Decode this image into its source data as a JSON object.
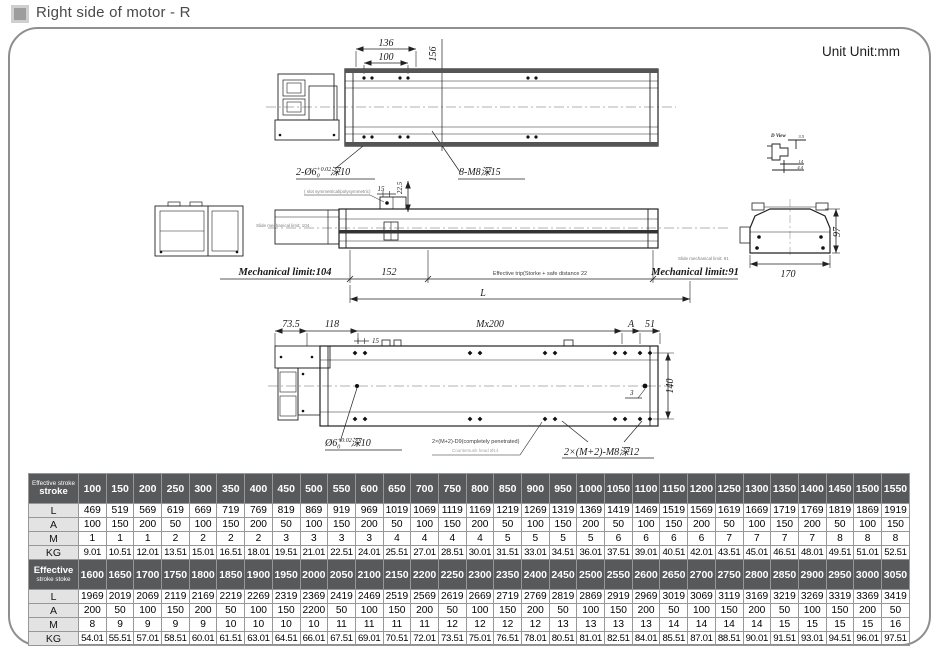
{
  "page": {
    "title": "Right side of motor - R",
    "unit_label": "Unit Unit:mm"
  },
  "drawings": {
    "top_view": {
      "dim_width_outer": "136",
      "dim_width_inner": "100",
      "dim_height": "156",
      "hole_pre": "2-Ø6",
      "hole_sup": "+0.02",
      "hole_sub": "0",
      "hole_post": "深10",
      "tap_label": "8-M8深15"
    },
    "side_view": {
      "note": "( slot symmetrical/polysymmetric)",
      "dim_block": "15",
      "dim_height": "22.5",
      "slide_limit_left": "Slide mechanical limit: 104",
      "mech_limit_left": "Mechanical limit:104",
      "dim_152": "152",
      "effective_trip": "Effective trip(Storke + safe distance 22",
      "dim_total": "L",
      "slide_limit_right": "Slide mechanical limit: 91",
      "mech_limit_right": "Mechanical limit:91"
    },
    "d_view": {
      "title": "D View",
      "dim1": "3.5",
      "dim2": "14",
      "dim3": "4.4"
    },
    "cross_section": {
      "dim_width": "170",
      "dim_height": "97"
    },
    "bottom_view": {
      "dim_735": "73.5",
      "dim_118": "118",
      "dim_15": "15",
      "dim_pitch": "Mx200",
      "dim_a": "A",
      "dim_51": "51",
      "dim_3": "3",
      "dim_140": "140",
      "hole_pre": "Ø6",
      "hole_sup": "+0.02",
      "hole_sub": "0",
      "hole_post": "深10",
      "through_label": "2×(M+2)-D9(completely penetrated)",
      "counter_label": "Countersunk head Ø14",
      "tap_label": "2×(M+2)-M8深12"
    }
  },
  "tables": [
    {
      "header": {
        "line1": "Effective stroke",
        "line2": "stroke",
        "big": "line2"
      },
      "strokes": [
        100,
        150,
        200,
        250,
        300,
        350,
        400,
        450,
        500,
        550,
        600,
        650,
        700,
        750,
        800,
        850,
        900,
        950,
        1000,
        1050,
        1100,
        1150,
        1200,
        1250,
        1300,
        1350,
        1400,
        1450,
        1500,
        1550
      ],
      "rows": [
        {
          "label": "L",
          "values": [
            469,
            519,
            569,
            619,
            669,
            719,
            769,
            819,
            869,
            919,
            969,
            1019,
            1069,
            1119,
            1169,
            1219,
            1269,
            1319,
            1369,
            1419,
            1469,
            1519,
            1569,
            1619,
            1669,
            1719,
            1769,
            1819,
            1869,
            1919
          ]
        },
        {
          "label": "A",
          "values": [
            100,
            150,
            200,
            50,
            100,
            150,
            200,
            50,
            100,
            150,
            200,
            50,
            100,
            150,
            200,
            50,
            100,
            150,
            200,
            50,
            100,
            150,
            200,
            50,
            100,
            150,
            200,
            50,
            100,
            150
          ]
        },
        {
          "label": "M",
          "values": [
            1,
            1,
            1,
            2,
            2,
            2,
            2,
            3,
            3,
            3,
            3,
            4,
            4,
            4,
            4,
            5,
            5,
            5,
            5,
            6,
            6,
            6,
            6,
            7,
            7,
            7,
            7,
            8,
            8,
            8
          ]
        },
        {
          "label": "KG",
          "values": [
            "9.01",
            "10.51",
            "12.01",
            "13.51",
            "15.01",
            "16.51",
            "18.01",
            "19.51",
            "21.01",
            "22.51",
            "24.01",
            "25.51",
            "27.01",
            "28.51",
            "30.01",
            "31.51",
            "33.01",
            "34.51",
            "36.01",
            "37.51",
            "39.01",
            "40.51",
            "42.01",
            "43.51",
            "45.01",
            "46.51",
            "48.01",
            "49.51",
            "51.01",
            "52.51"
          ]
        }
      ]
    },
    {
      "header": {
        "line1": "Effective",
        "line2": "stroke stoke",
        "big": "line1"
      },
      "strokes": [
        1600,
        1650,
        1700,
        1750,
        1800,
        1850,
        1900,
        1950,
        2000,
        2050,
        2100,
        2150,
        2200,
        2250,
        2300,
        2350,
        2400,
        2450,
        2500,
        2550,
        2600,
        2650,
        2700,
        2750,
        2800,
        2850,
        2900,
        2950,
        3000,
        3050
      ],
      "rows": [
        {
          "label": "L",
          "values": [
            1969,
            2019,
            2069,
            2119,
            2169,
            2219,
            2269,
            2319,
            2369,
            2419,
            2469,
            2519,
            2569,
            2619,
            2669,
            2719,
            2769,
            2819,
            2869,
            2919,
            2969,
            3019,
            3069,
            3119,
            3169,
            3219,
            3269,
            3319,
            3369,
            3419
          ]
        },
        {
          "label": "A",
          "values": [
            200,
            50,
            100,
            150,
            200,
            50,
            100,
            150,
            2200,
            50,
            100,
            150,
            200,
            50,
            100,
            150,
            200,
            50,
            100,
            150,
            200,
            50,
            100,
            150,
            200,
            50,
            100,
            150,
            200,
            50
          ]
        },
        {
          "label": "M",
          "values": [
            8,
            9,
            9,
            9,
            9,
            10,
            10,
            10,
            10,
            11,
            11,
            11,
            11,
            12,
            12,
            12,
            12,
            13,
            13,
            13,
            13,
            14,
            14,
            14,
            14,
            15,
            15,
            15,
            15,
            16
          ]
        },
        {
          "label": "KG",
          "values": [
            "54.01",
            "55.51",
            "57.01",
            "58.51",
            "60.01",
            "61.51",
            "63.01",
            "64.51",
            "66.01",
            "67.51",
            "69.01",
            "70.51",
            "72.01",
            "73.51",
            "75.01",
            "76.51",
            "78.01",
            "80.51",
            "81.01",
            "82.51",
            "84.01",
            "85.51",
            "87.01",
            "88.51",
            "90.01",
            "91.51",
            "93.01",
            "94.51",
            "96.01",
            "97.51"
          ]
        }
      ]
    }
  ]
}
